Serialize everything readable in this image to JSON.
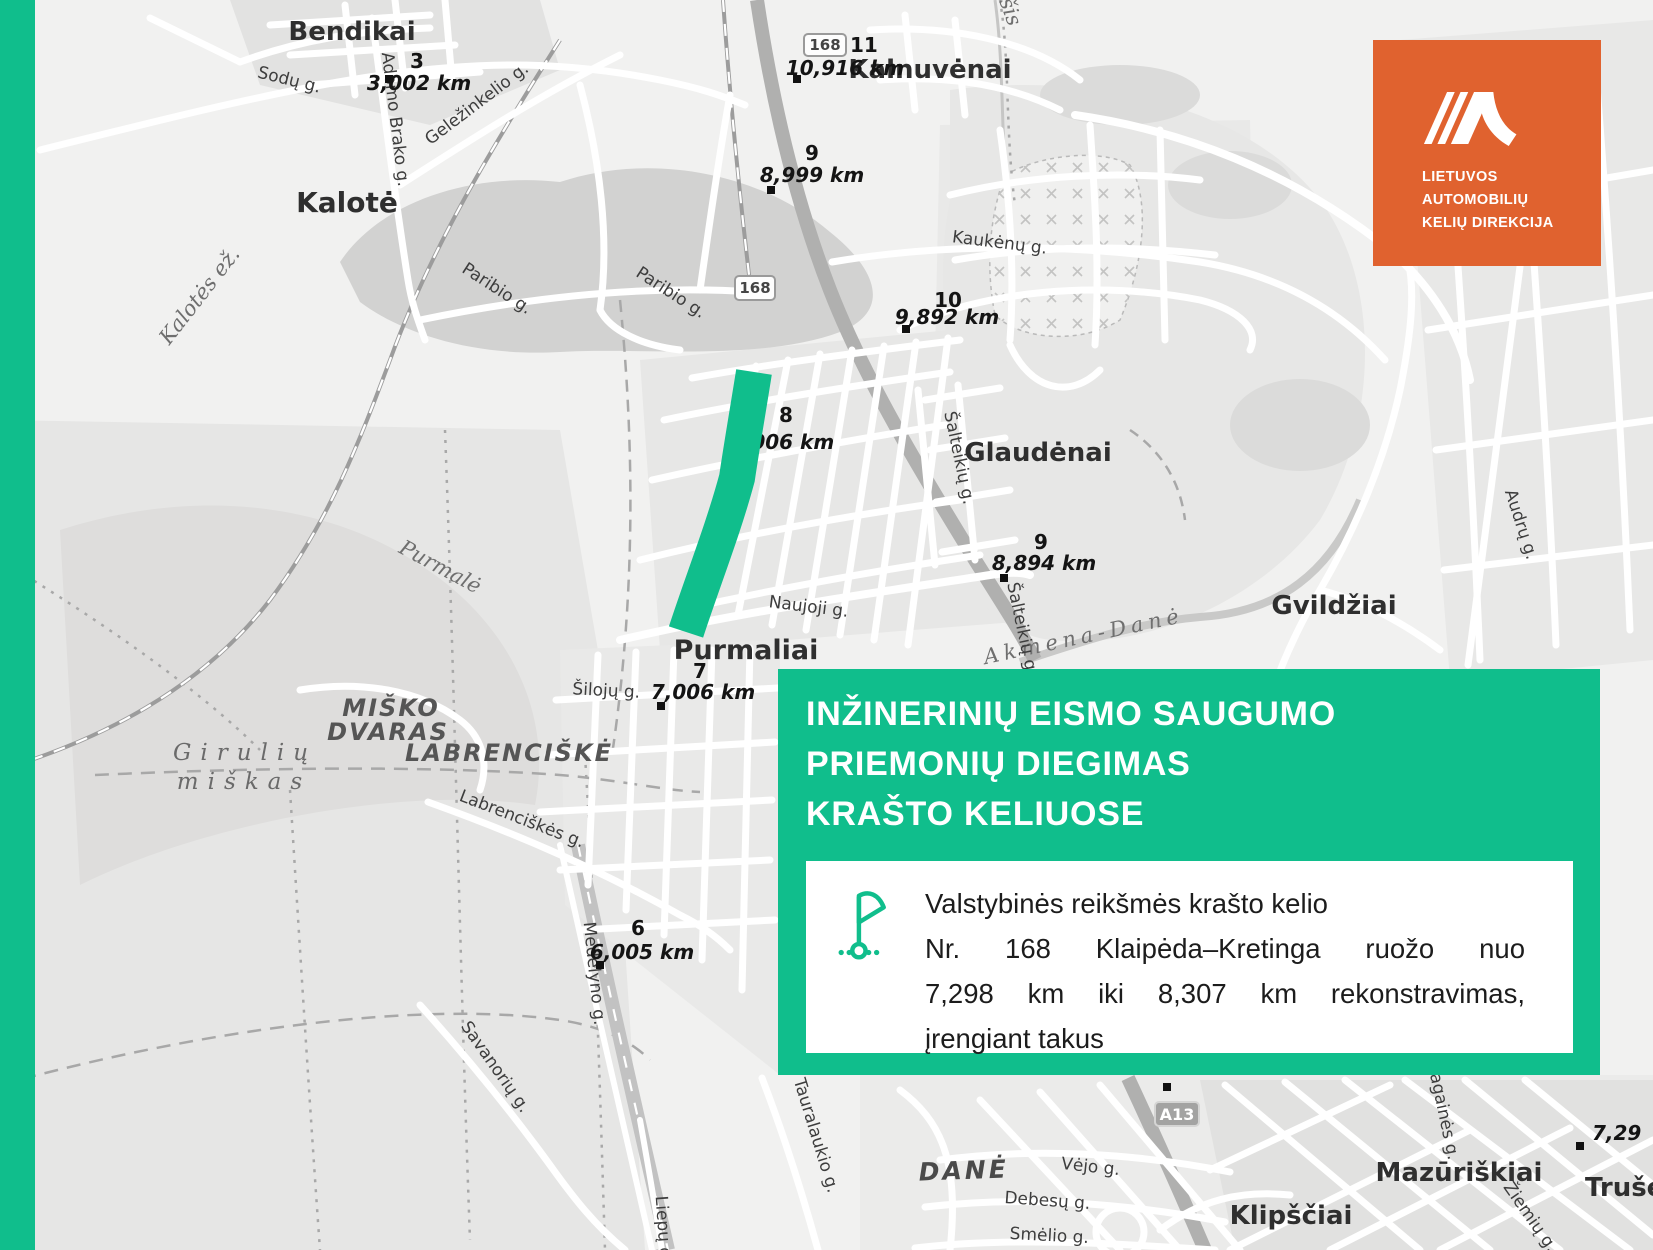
{
  "colors": {
    "green": "#10BE8C",
    "orange": "#E0622F"
  },
  "logo": {
    "line1": "LIETUVOS",
    "line2": "AUTOMOBILIŲ",
    "line3": "KELIŲ DIREKCIJA"
  },
  "banner": {
    "title1": "INŽINERINIŲ EISMO SAUGUMO",
    "title2": "PRIEMONIŲ DIEGIMAS",
    "title3": "KRAŠTO KELIUOSE",
    "info1": "Valstybinės reikšmės krašto kelio",
    "info2": "Nr. 168 Klaipėda–Kretinga ruožo nuo",
    "info3": "7,298 km iki 8,307 km rekonstravimas,",
    "info4": "įrengiant takus"
  },
  "map": {
    "places": {
      "bendikai": "Bendikai",
      "kalote": "Kalotė",
      "kalnuvenai": "Kalnuvėnai",
      "glaudenai": "Glaudėnai",
      "gvildziai": "Gvildžiai",
      "purmaliai": "Purmaliai",
      "mazuriskiai": "Mazūriškiai",
      "klipsciai": "Klipščiai",
      "truseliai": "Trušeliai",
      "dane": "DANĖ",
      "misko1": "MIŠKO",
      "misko2": "DVARAS",
      "labrenciske": "LABRENCIŠKĖ",
      "giruliu1": "Girulių",
      "giruliu2": "miškas"
    },
    "waters": {
      "kalotes_ez": "Kalotės ež.",
      "purmale": "Purmalė",
      "akmena": "Akmena-Danė",
      "sis": "šis"
    },
    "streets": {
      "sodu": "Sodų g.",
      "adomo": "Adomo Brako g.",
      "gelezinkelio": "Geležinkelio g.",
      "paribio": "Paribio g.",
      "kaukenu": "Kaukėnų g.",
      "salteikiu": "Šalteikių g.",
      "naujoji": "Naujoji g.",
      "siloju": "Šilojų g.",
      "labrenciskes": "Labrenciškės g.",
      "savanoriu": "Savanorių g.",
      "medelyno": "Medelyno g.",
      "liepu": "Liepų g.",
      "tauralaukio": "Tauralaukio g.",
      "vejo": "Vėjo g.",
      "debesu": "Debesų g.",
      "smelio": "Smėlio g.",
      "audru": "Audrų g.",
      "ragaines": "Ragainės g.",
      "ziemiu": "Žiemių g."
    },
    "markers": [
      {
        "n": "3",
        "v": "3,002 km"
      },
      {
        "n": "11",
        "v": "10,916 km"
      },
      {
        "n": "9",
        "v": "8,999 km"
      },
      {
        "n": "10",
        "v": "9,892 km"
      },
      {
        "n": "8",
        "v": "8,006 km"
      },
      {
        "n": "9",
        "v": "8,894 km"
      },
      {
        "n": "7",
        "v": "7,006 km"
      },
      {
        "n": "6",
        "v": "6,005 km"
      },
      {
        "n": "",
        "v": "7,29"
      }
    ],
    "shields": {
      "r168": "168",
      "a13": "A13"
    }
  }
}
